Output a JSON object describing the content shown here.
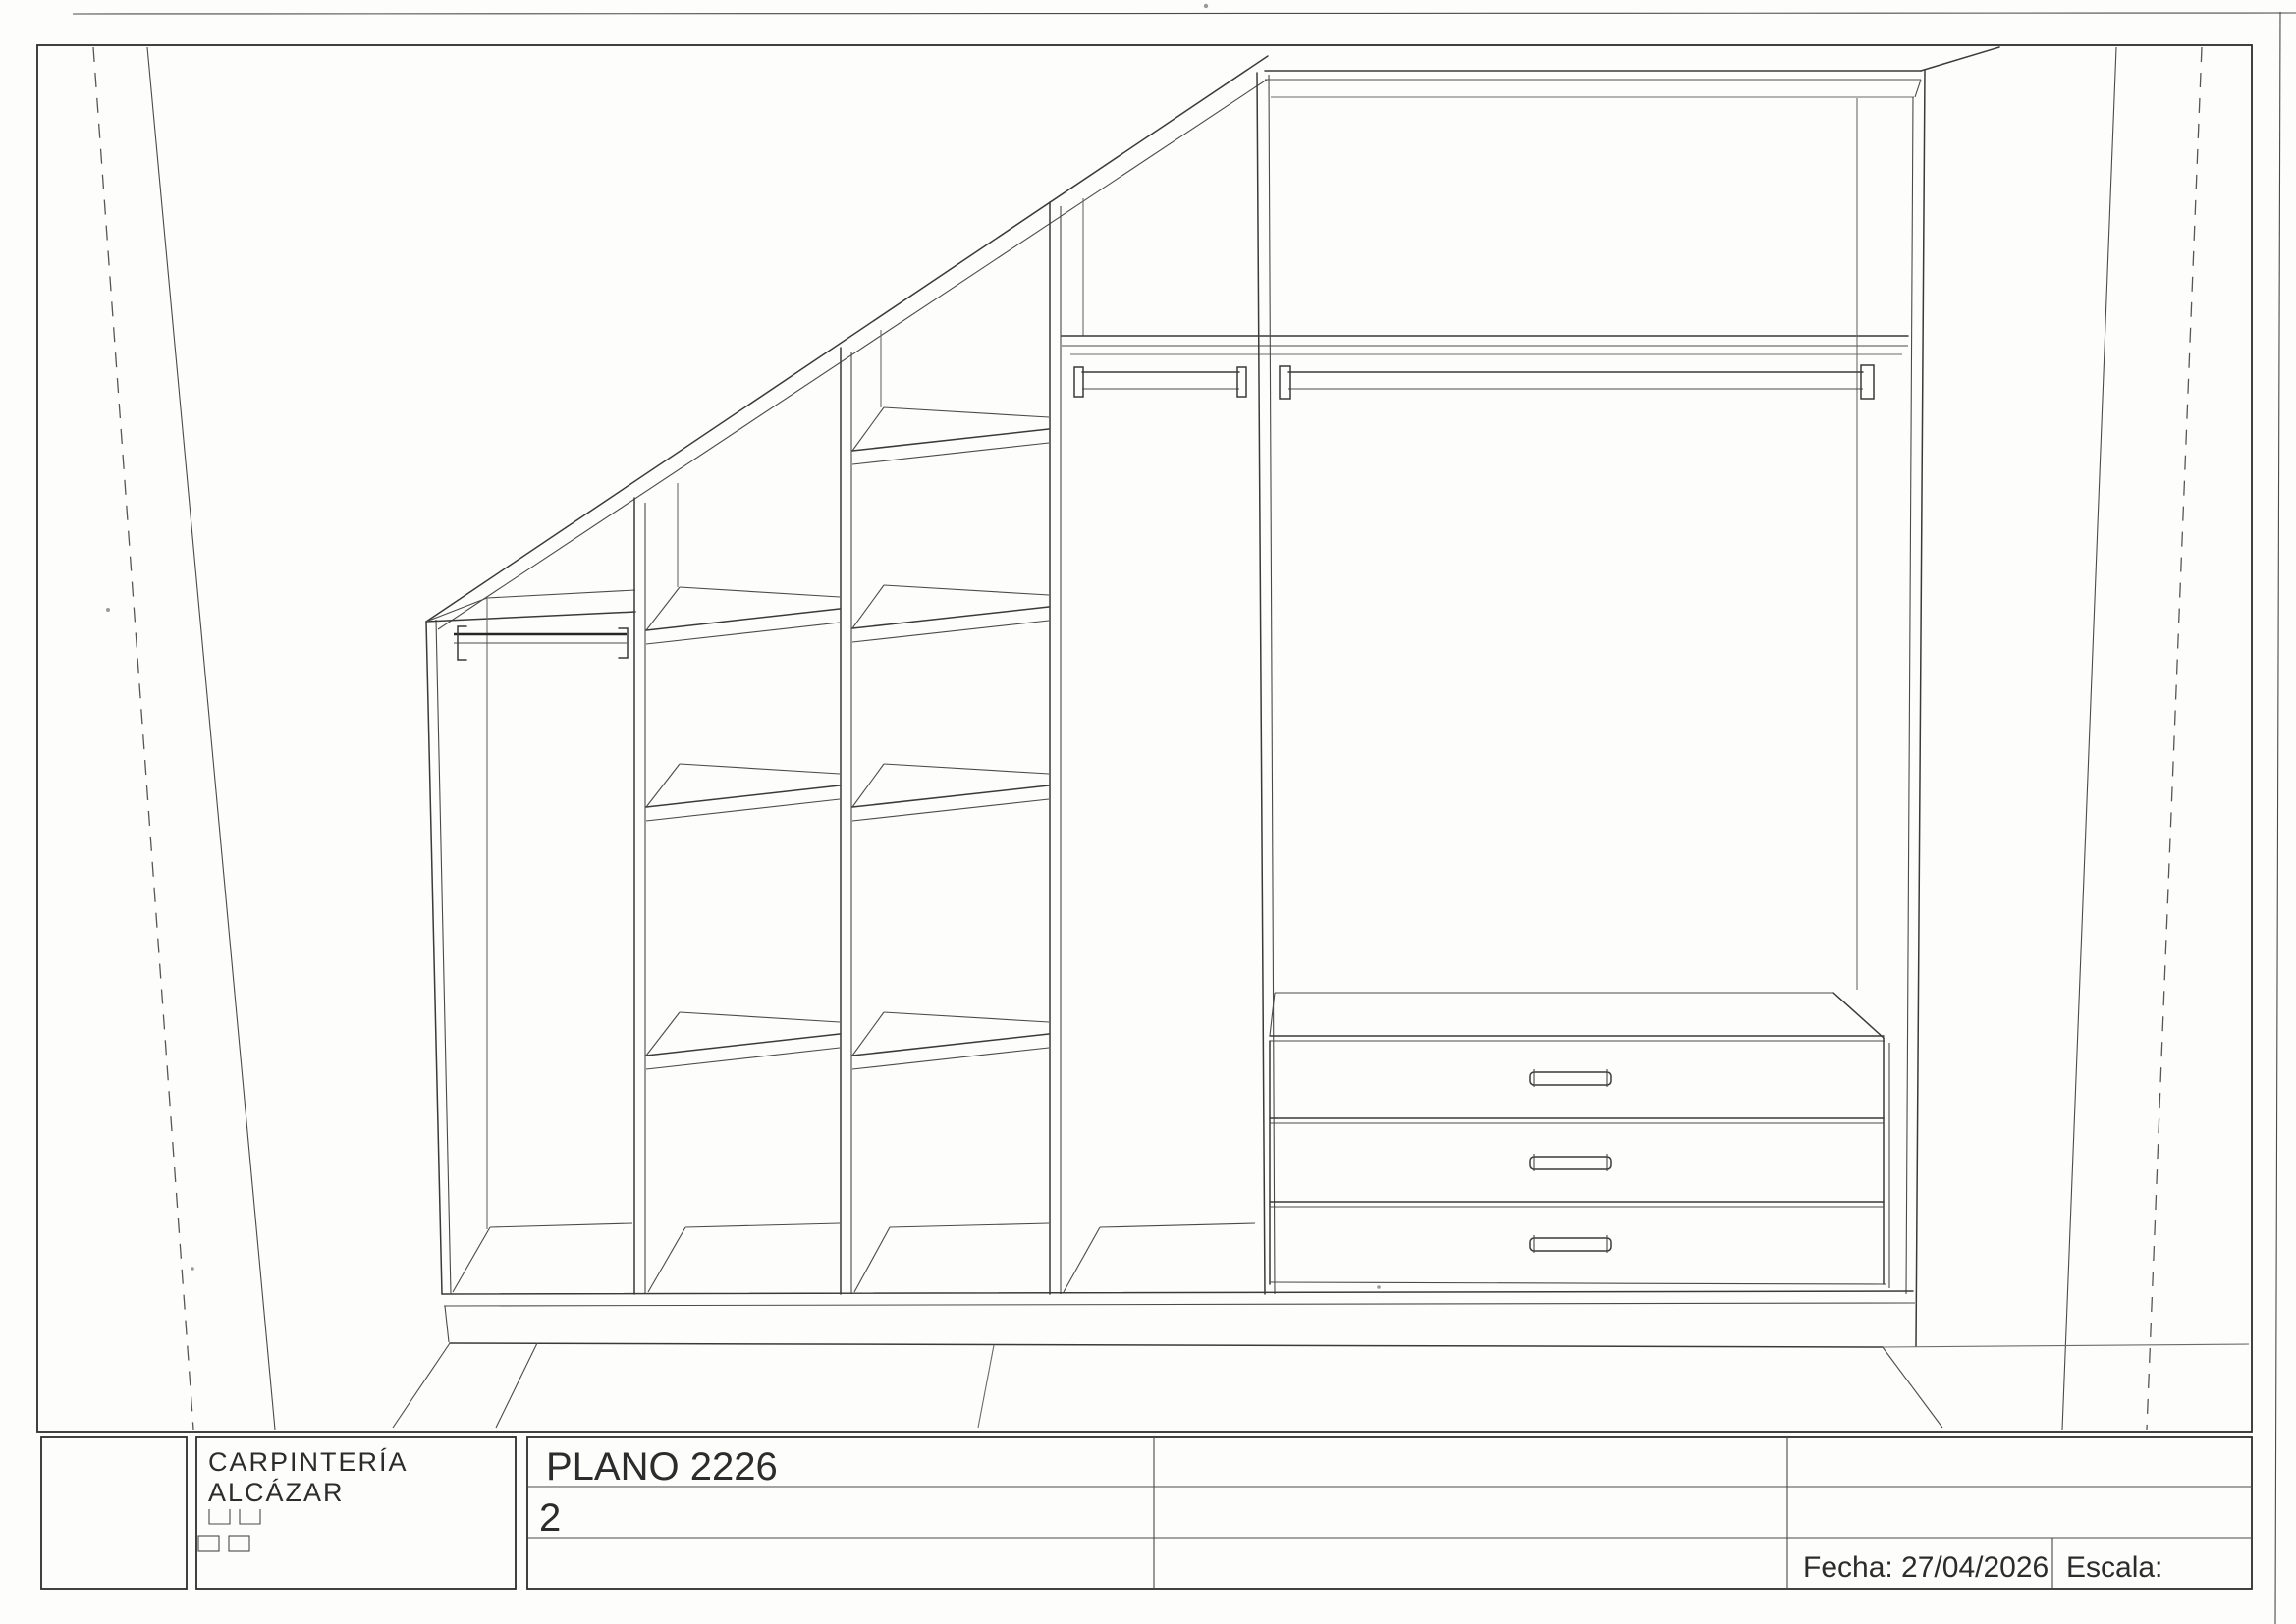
{
  "title_block": {
    "company_line1": "CARPINTERÍA",
    "company_line2": "ALCÁZAR",
    "plan_title": "PLANO 2226",
    "sheet_number": "2",
    "date_label": "Fecha: 27/04/2026",
    "scale_label": "Escala:"
  },
  "colors": {
    "paper": "#fdfdfc",
    "ink": "#3a3a3a"
  }
}
